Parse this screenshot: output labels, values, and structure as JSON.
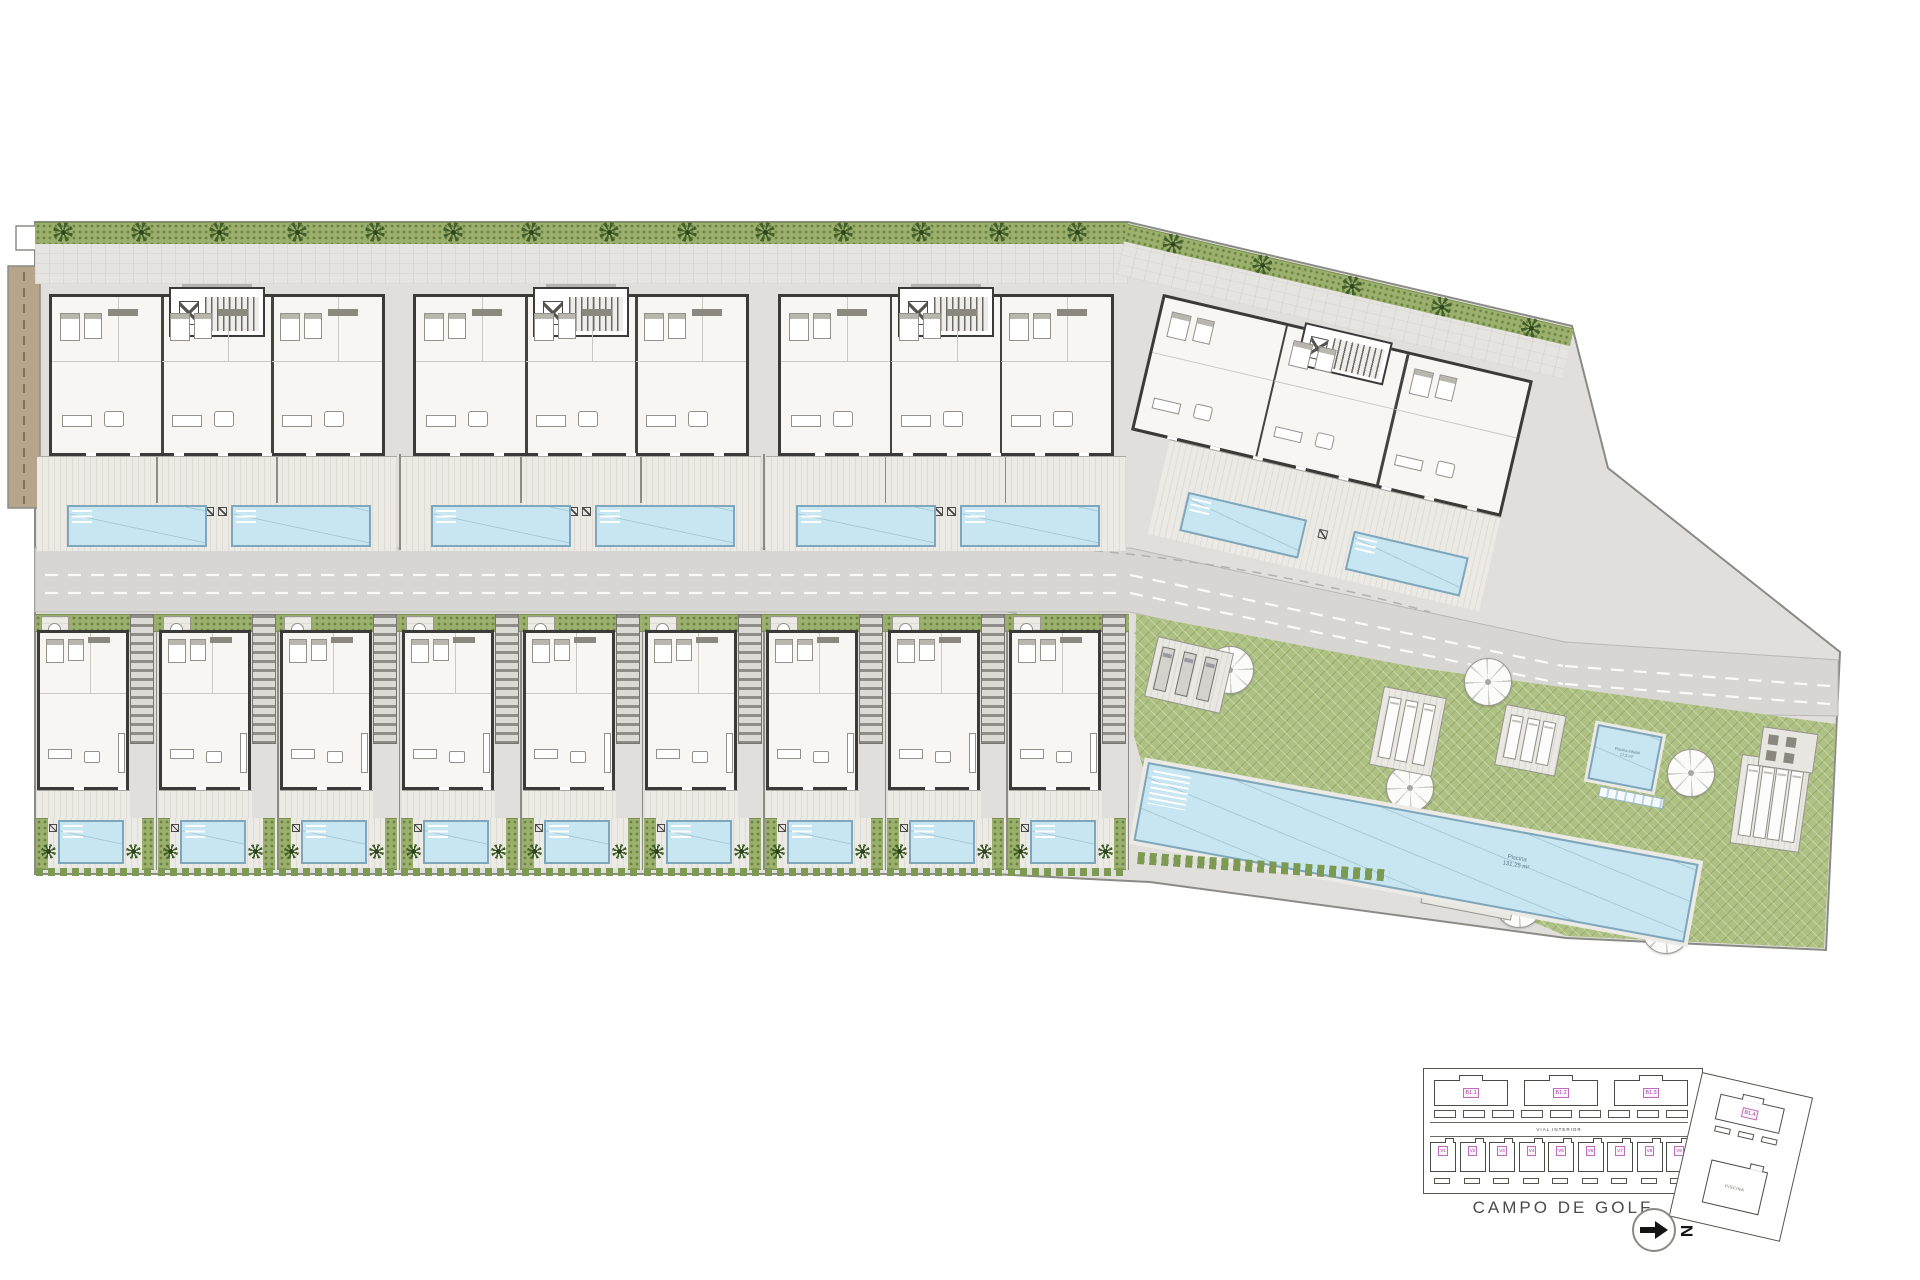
{
  "key_plan": {
    "blocks": [
      "B1.1",
      "B1.2",
      "B1.3"
    ],
    "wing_block_label": "B1.4",
    "villas": [
      "V1",
      "V2",
      "V3",
      "V4",
      "V5",
      "V6",
      "V7",
      "V8",
      "V9"
    ],
    "road_label": "VIAL INTERIOR",
    "pool_building_label": "PISCINA",
    "golf_label": "CAMPO DE GOLF",
    "north_letter": "N"
  },
  "communal_area": {
    "main_pool": {
      "name": "Piscina",
      "area": "131,25 m²"
    },
    "kids_pool": {
      "name": "Piscina infantil",
      "area": "17,5 m²"
    },
    "parasol_count": 6
  },
  "site": {
    "apartment_block_count": 3,
    "wing_block_count": 1,
    "villa_count": 9,
    "pools_per_apartment_block": 2,
    "pools_per_villa": 1
  },
  "colors": {
    "pool_water": "#c8e6f2",
    "lawn_green": "#aec183",
    "hedge_green": "#9cb06e",
    "palm_green": "#42602c",
    "pavement": "#e0dfdc",
    "road": "#d7d6d2",
    "dirt_path": "#b7a58b",
    "wall_dark": "#3a3a38",
    "label_magenta": "#9c3d96"
  }
}
